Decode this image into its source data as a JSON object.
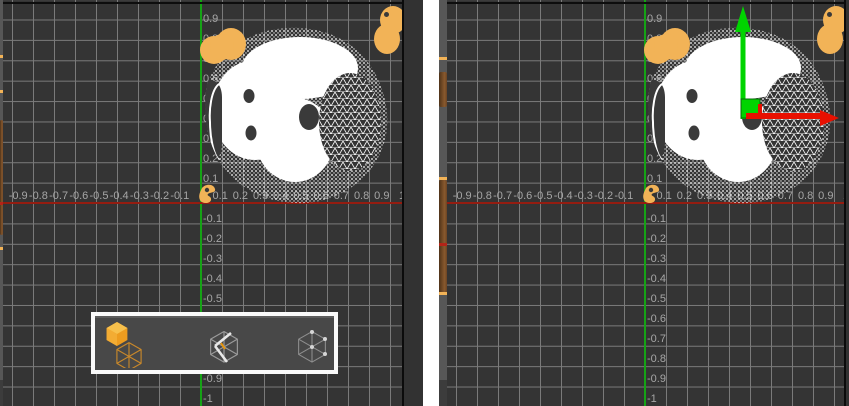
{
  "app": {
    "view": "dual orthographic viewports showing a head mesh from the top",
    "selected_object": "head-mesh"
  },
  "axis": {
    "unit_step": 0.1,
    "x_labels": [
      {
        "text": "-0.9",
        "value": -0.9
      },
      {
        "text": "-0.8",
        "value": -0.8
      },
      {
        "text": "-0.7",
        "value": -0.7
      },
      {
        "text": "-0.6",
        "value": -0.6
      },
      {
        "text": "-0.5",
        "value": -0.5
      },
      {
        "text": "-0.4",
        "value": -0.4
      },
      {
        "text": "-0.3",
        "value": -0.3
      },
      {
        "text": "-0.2",
        "value": -0.2
      },
      {
        "text": "-0.1",
        "value": -0.1
      },
      {
        "text": "0.1",
        "value": 0.1
      },
      {
        "text": "0.2",
        "value": 0.2
      },
      {
        "text": "0.3",
        "value": 0.3
      },
      {
        "text": "0.4",
        "value": 0.4
      },
      {
        "text": "0.5",
        "value": 0.5
      },
      {
        "text": "0.6",
        "value": 0.6
      },
      {
        "text": "0.7",
        "value": 0.7
      },
      {
        "text": "0.8",
        "value": 0.8
      },
      {
        "text": "0.9",
        "value": 0.9
      },
      {
        "text": "1",
        "value": 1
      }
    ],
    "y_labels": [
      {
        "text": "0.9",
        "value": 0.9
      },
      {
        "text": "0.8",
        "value": 0.8
      },
      {
        "text": "0.7",
        "value": 0.7
      },
      {
        "text": "0.6",
        "value": 0.6
      },
      {
        "text": "0.5",
        "value": 0.5
      },
      {
        "text": "0.4",
        "value": 0.4
      },
      {
        "text": "0.3",
        "value": 0.3
      },
      {
        "text": "0.2",
        "value": 0.2
      },
      {
        "text": "0.1",
        "value": 0.1
      },
      {
        "text": "-0.1",
        "value": -0.1
      },
      {
        "text": "-0.2",
        "value": -0.2
      },
      {
        "text": "-0.3",
        "value": -0.3
      },
      {
        "text": "-0.4",
        "value": -0.4
      },
      {
        "text": "-0.5",
        "value": -0.5
      },
      {
        "text": "-0.6",
        "value": -0.6
      },
      {
        "text": "-0.7",
        "value": -0.7
      },
      {
        "text": "-0.8",
        "value": -0.8
      },
      {
        "text": "-0.9",
        "value": -0.9
      },
      {
        "text": "-1",
        "value": -1
      }
    ]
  },
  "viewports": [
    {
      "id": "left",
      "content": "head-mesh-top-view",
      "has_mode_toolbar": true,
      "has_gizmo": false
    },
    {
      "id": "right",
      "content": "head-mesh-top-view",
      "has_mode_toolbar": false,
      "has_gizmo": true
    }
  ],
  "toolbar": {
    "modes": [
      {
        "id": "face-select-mode",
        "icon": "faceted-hexagon-icon",
        "selected": true
      },
      {
        "id": "edge-select-mode",
        "icon": "hexagon-edges-icon",
        "selected": false
      },
      {
        "id": "vertex-select-mode",
        "icon": "hexagon-vertices-icon",
        "selected": false
      }
    ]
  },
  "gizmo": {
    "type": "translate",
    "axes": [
      {
        "name": "y",
        "color": "#00d400"
      },
      {
        "name": "x",
        "color": "#e81000"
      }
    ]
  },
  "colors": {
    "selection_orange": "#F2B357",
    "axis_green": "#15A315",
    "axis_red": "#941C10",
    "gizmo_green": "#00D400",
    "gizmo_red": "#E81000",
    "grid_bg": "#343434",
    "grid_line": "#7A7A7A"
  }
}
